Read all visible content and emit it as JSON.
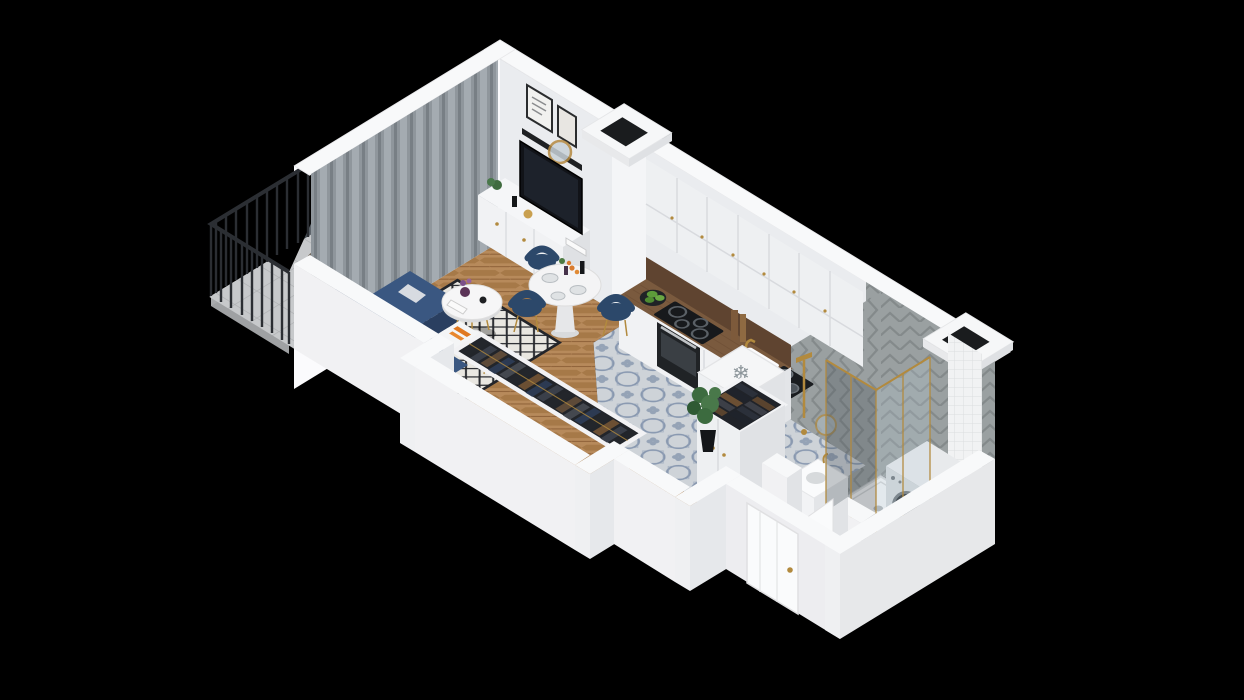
{
  "scene": {
    "type": "isometric-3d-floor-plan-render",
    "title": "Studio apartment 3D floor plan",
    "background_label": "black backdrop",
    "rooms": [
      {
        "name": "Balcony",
        "features": [
          "dark metal railing",
          "white parapet",
          "rattan chair",
          "potted plants",
          "gray tiled floor"
        ]
      },
      {
        "name": "Living room",
        "features": [
          "gray curtains",
          "glass balcony door",
          "navy corner sofa",
          "black and white patterned rug",
          "round white coffee table",
          "white floor lamp",
          "side table",
          "white TV sideboard",
          "flat-screen TV",
          "black wall shelf with framed art",
          "round gold mirror",
          "round white dining table",
          "navy dining chairs",
          "herringbone wood floor"
        ]
      },
      {
        "name": "Kitchen",
        "features": [
          "white upper cabinets",
          "white base cabinets",
          "wooden countertop",
          "black cooktop",
          "built-in oven",
          "sink with gold faucet",
          "bowl of green apples",
          "cutting boards",
          "fridge block marked with snowflake",
          "blue patterned tile floor"
        ]
      },
      {
        "name": "Hallway",
        "features": [
          "open wardrobe full of clothes",
          "second open wardrobe",
          "potted plant",
          "white entrance door",
          "gray tile floor"
        ]
      },
      {
        "name": "Bathroom",
        "features": [
          "walk-in shower with gold framed glass",
          "white shower tray",
          "washing machine",
          "white vanity sink",
          "round gold mirror",
          "gray herringbone wall tiles",
          "gray tile floor",
          "open white door",
          "two rooftop ventilation ducts"
        ]
      }
    ]
  },
  "icons": {
    "snowflake_glyph": "❄",
    "snowflake_meaning": "fridge position marker"
  },
  "colors": {
    "background": "#000000",
    "wall_top": "#f8f9fa",
    "wall_front": "#f1f1f3",
    "wall_end": "#e1e3e6",
    "wall_interior": "#eaecef",
    "wall_exterior": "#fbfbfd",
    "window_glass": "#4a5258",
    "curtain": "#8f969c",
    "railing": "#2b2e33",
    "sofa_back": "#2a4163",
    "sofa_seat": "#3a5781",
    "chair_navy": "#2c486a",
    "rug_base": "#e9e7e1",
    "rug_line": "#26282d",
    "wood_floor": "#b78a5b",
    "kitchen_tile": "#ced3d8",
    "tile_accent": "#6f83a0",
    "bath_wall": "#9aa0a1",
    "bath_floor": "#b9bcbf",
    "hall_floor": "#b2b5b8",
    "counter_wood": "#7a5a3e",
    "backsplash": "#5f4430",
    "appliance_black": "#17191c",
    "washer_door": "#20262c",
    "duct_hole": "#1a1c1e",
    "gold": "#b28a3e",
    "door_white": "#fafbfc",
    "plant_green": "#3f6b3f",
    "apple_green": "#5d9b3a",
    "orange_accent": "#e07820"
  }
}
